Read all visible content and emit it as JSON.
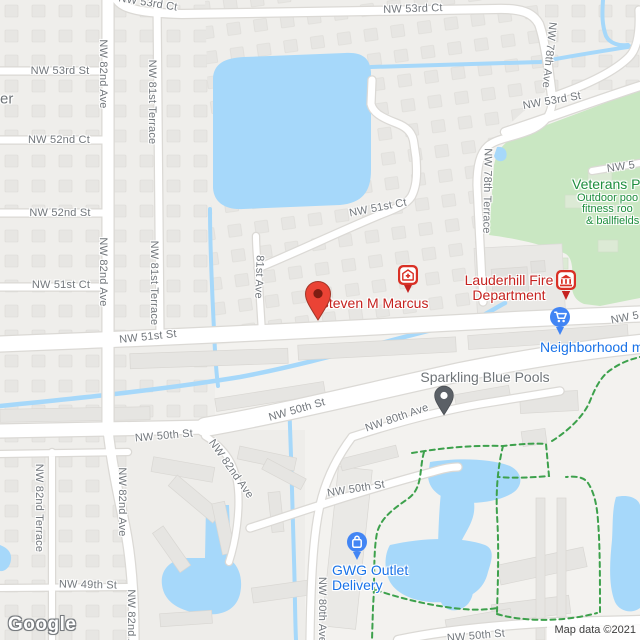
{
  "attribution": "Map data ©2021",
  "logo_text": "Google",
  "colors": {
    "water": "#a6d8fa",
    "park": "#c9e7c2",
    "park_pad": "#dcead5",
    "trail": "#3da14c",
    "road_fill": "#ffffff",
    "road_casing": "#dbd9d5",
    "land": "#f3f2ef",
    "block": "#efeeeb",
    "building": "#e7e6e3",
    "pin_red": "#d93025",
    "pin_red_dark": "#7e1d12",
    "marker_blue": "#4285f4",
    "marker_gray": "#5b6066",
    "poi_red": "#c5221f",
    "poi_blue": "#1a73e8",
    "poi_green": "#1e8e3e",
    "poi_gray": "#6f7478",
    "street_text": "#72777c"
  },
  "street_labels": [
    {
      "text": "NW 53rd Ct",
      "x": 148,
      "y": 3,
      "rot": 9
    },
    {
      "text": "NW 53rd Ct",
      "x": 413,
      "y": 9,
      "rot": -2
    },
    {
      "text": "NW 53rd St",
      "x": 60,
      "y": 71,
      "rot": 0
    },
    {
      "text": "NW 52nd Ct",
      "x": 59,
      "y": 140,
      "rot": 0
    },
    {
      "text": "NW 52nd St",
      "x": 60,
      "y": 213,
      "rot": 0
    },
    {
      "text": "NW 51st Ct",
      "x": 61,
      "y": 285,
      "rot": 0
    },
    {
      "text": "NW 51st St",
      "x": 148,
      "y": 337,
      "rot": -6
    },
    {
      "text": "NW 82nd Ave",
      "x": 103,
      "y": 74,
      "rot": 90
    },
    {
      "text": "NW 82nd Ave",
      "x": 103,
      "y": 272,
      "rot": 90
    },
    {
      "text": "NW 81st Terrace",
      "x": 152,
      "y": 102,
      "rot": 90
    },
    {
      "text": "NW 81st Terrace",
      "x": 154,
      "y": 283,
      "rot": 90
    },
    {
      "text": "81st Ave",
      "x": 259,
      "y": 277,
      "rot": 92
    },
    {
      "text": "NW 51st Ct",
      "x": 378,
      "y": 208,
      "rot": -11
    },
    {
      "text": "NW 78th Ave",
      "x": 549,
      "y": 55,
      "rot": 96
    },
    {
      "text": "NW 53rd St",
      "x": 552,
      "y": 101,
      "rot": -10
    },
    {
      "text": "NW 78th Terrace",
      "x": 487,
      "y": 191,
      "rot": 91
    },
    {
      "text": "NW 5",
      "x": 621,
      "y": 167,
      "rot": -8
    },
    {
      "text": "NW 5",
      "x": 625,
      "y": 318,
      "rot": -11
    },
    {
      "text": "NW 50th St",
      "x": 164,
      "y": 436,
      "rot": -5
    },
    {
      "text": "NW 50th St",
      "x": 297,
      "y": 410,
      "rot": -16
    },
    {
      "text": "NW 50th St",
      "x": 356,
      "y": 489,
      "rot": -9
    },
    {
      "text": "NW 50th St",
      "x": 476,
      "y": 636,
      "rot": -5
    },
    {
      "text": "NW 80th Ave",
      "x": 397,
      "y": 418,
      "rot": -19
    },
    {
      "text": "NW 80th Ave",
      "x": 322,
      "y": 610,
      "rot": 90
    },
    {
      "text": "NW 82nd Ave",
      "x": 122,
      "y": 502,
      "rot": 90
    },
    {
      "text": "NW 82nd Ave",
      "x": 231,
      "y": 469,
      "rot": 55
    },
    {
      "text": "NW 82nd Terrace",
      "x": 39,
      "y": 508,
      "rot": 90
    },
    {
      "text": "NW 49th St",
      "x": 88,
      "y": 585,
      "rot": 1
    },
    {
      "text": "NW 82nd Ave",
      "x": 131,
      "y": 624,
      "rot": 90
    }
  ],
  "poi_labels": [
    {
      "text": "Steven M Marcus",
      "x": 374,
      "y": 303,
      "size": 14,
      "color": "poi_red",
      "align": "center",
      "name": "poi-label-steven-m-marcus"
    },
    {
      "text": "Lauderhill Fire",
      "x": 509,
      "y": 280,
      "size": 14,
      "color": "poi_red",
      "align": "center",
      "name": "poi-label-lauderhill-fire-1"
    },
    {
      "text": "Department",
      "x": 509,
      "y": 295,
      "size": 14,
      "color": "poi_red",
      "align": "center",
      "name": "poi-label-lauderhill-fire-2"
    },
    {
      "text": "Veterans P",
      "x": 572,
      "y": 184,
      "size": 14,
      "color": "poi_green",
      "align": "left",
      "name": "poi-label-veterans-park"
    },
    {
      "text": "Outdoor poo",
      "x": 577,
      "y": 198,
      "size": 11,
      "color": "poi_green",
      "align": "left",
      "name": "poi-label-veterans-sub-1"
    },
    {
      "text": "fitness roo",
      "x": 582,
      "y": 209,
      "size": 11,
      "color": "poi_green",
      "align": "left",
      "name": "poi-label-veterans-sub-2"
    },
    {
      "text": "& ballfields",
      "x": 586,
      "y": 221,
      "size": 11,
      "color": "poi_green",
      "align": "left",
      "name": "poi-label-veterans-sub-3"
    },
    {
      "text": "Neighborhood m",
      "x": 540,
      "y": 347,
      "size": 14,
      "color": "poi_blue",
      "align": "left",
      "name": "poi-label-neighborhood-market"
    },
    {
      "text": "Sparkling Blue Pools",
      "x": 485,
      "y": 377,
      "size": 14,
      "color": "poi_gray",
      "align": "center",
      "name": "poi-label-sparkling-blue-pools"
    },
    {
      "text": "GWG Outlet",
      "x": 332,
      "y": 570,
      "size": 14,
      "color": "poi_blue",
      "align": "left",
      "name": "poi-label-gwg-outlet"
    },
    {
      "text": "Delivery",
      "x": 332,
      "y": 585,
      "size": 14,
      "color": "poi_blue",
      "align": "left",
      "name": "poi-label-gwg-delivery"
    },
    {
      "text": "er",
      "x": 0,
      "y": 99,
      "size": 15,
      "color": "poi_gray",
      "align": "left",
      "name": "poi-label-edge-fragment"
    }
  ],
  "markers": [
    {
      "type": "pin-classic",
      "x": 318,
      "y": 322,
      "name": "steven-m-marcus-pin"
    },
    {
      "type": "pin-doctor",
      "x": 408,
      "y": 294,
      "name": "medical-poi-pin"
    },
    {
      "type": "pin-civic",
      "x": 566,
      "y": 301,
      "name": "fire-department-pin"
    },
    {
      "type": "pin-cart",
      "x": 560,
      "y": 336,
      "name": "neighborhood-market-pin"
    },
    {
      "type": "pin-bag",
      "x": 357,
      "y": 561,
      "name": "gwg-outlet-pin"
    },
    {
      "type": "pin-gray",
      "x": 444,
      "y": 416,
      "name": "sparkling-blue-pools-pin"
    }
  ]
}
